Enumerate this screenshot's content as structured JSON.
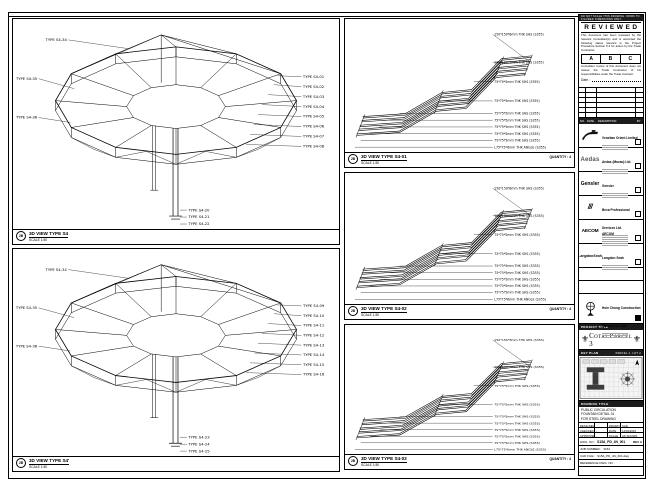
{
  "panels": {
    "p1": {
      "bubble": "2B",
      "title": "3D VIEW TYPE S4",
      "scale": "SCALE 1:50",
      "top_labels": [
        "TYPE S4-34"
      ],
      "left_labels": [
        "TYPE S4-35",
        "TYPE S4-36"
      ],
      "right_labels": [
        "TYPE S4-01",
        "TYPE S4-02",
        "TYPE S4-03",
        "TYPE S4-04",
        "TYPE S4-05",
        "TYPE S4-06",
        "TYPE S4-07",
        "TYPE S4-08"
      ],
      "bottom_labels": [
        "TYPE S4-20",
        "TYPE S4-21",
        "TYPE S4-22"
      ]
    },
    "p2": {
      "bubble": "2B",
      "title": "3D VIEW TYPE S4'",
      "scale": "SCALE 1:50",
      "top_labels": [
        "TYPE S4-34"
      ],
      "left_labels": [
        "TYPE S4-35",
        "TYPE S4-36"
      ],
      "right_labels": [
        "TYPE S4-09",
        "TYPE S4-10",
        "TYPE S4-11",
        "TYPE S4-12",
        "TYPE S4-13",
        "TYPE S4-14",
        "TYPE S4-15",
        "TYPE S4-16"
      ],
      "bottom_labels": [
        "TYPE S4-23",
        "TYPE S4-24",
        "TYPE S4-25"
      ]
    },
    "m1": {
      "bubble": "2B",
      "title": "3D VIEW TYPE S4-01",
      "scale": "SCALE 1:50",
      "quantity": "QUANTITY : 4",
      "labels": [
        "150*150*8mm THK SHS (S355)",
        "100*100*5mm THK SHS (S355)",
        "75*75*5mm THK SHS (S355)",
        "75*75*5mm THK SHS (S355)",
        "75*75*5mm THK SHS (S355)",
        "75*75*5mm THK SHS (S355)",
        "75*75*5mm THK SHS (S355)",
        "75*75*5mm THK SHS (S355)",
        "75*75*5mm THK SHS (S355)",
        "L75*75*6mm THK ANGLE (S355)"
      ]
    },
    "m2": {
      "bubble": "2B",
      "title": "3D VIEW TYPE S4-02",
      "scale": "SCALE 1:50",
      "quantity": "QUANTITY : 4",
      "labels": [
        "150*150*8mm THK SHS (S355)",
        "100*100*5mm THK SHS (S355)",
        "75*75*5mm THK SHS (S355)",
        "75*75*5mm THK SHS (S355)",
        "75*75*5mm THK SHS (S355)",
        "75*75*5mm THK SHS (S355)",
        "75*75*5mm THK SHS (S355)",
        "75*75*5mm THK SHS (S355)",
        "75*75*5mm THK SHS (S355)",
        "L75*75*6mm THK ANGLE (S355)"
      ]
    },
    "m3": {
      "bubble": "2B",
      "title": "3D VIEW TYPE S4-03",
      "scale": "SCALE 1:50",
      "quantity": "QUANTITY : 4",
      "labels": [
        "150*150*8mm THK SHS (S355)",
        "100*100*5mm THK SHS (S355)",
        "75*75*5mm THK SHS (S355)",
        "75*75*5mm THK SHS (S355)",
        "75*75*5mm THK SHS (S355)",
        "75*75*5mm THK SHS (S355)",
        "75*75*5mm THK SHS (S355)",
        "75*75*5mm THK SHS (S355)",
        "75*75*5mm THK SHS (S355)",
        "L75*75*6mm THK ANGLE (S355)"
      ]
    }
  },
  "titleblock": {
    "header_note": "DO NOT SCALE THIS DRAWING. WORK TO FIGURED DIMENSIONS ONLY.",
    "stamp": {
      "title": "REVIEWED",
      "note1": "This document has been reviewed by the relevant Consultant(s) and is accorded the following status relevant to the Project Procedure Section 5.4 for action by the Trade Contractor.",
      "options": [
        "A",
        "B",
        "C"
      ],
      "note2": "Consultant review of this document does not relieve the Trade Contractor of his responsibilities under the Trade Contract.",
      "date_label": "Date :"
    },
    "revision_table": {
      "col_no": "NO.",
      "col_date": "DATE",
      "col_desc": "DESCRIPTION",
      "col_by": "BY"
    },
    "consultants": [
      {
        "name": "Venetian Orient Limited"
      },
      {
        "logo": "Aedas",
        "name": "Aedas (Macau) Ltd."
      },
      {
        "logo": "Gensler",
        "name": "Gensler"
      },
      {
        "logo": "///",
        "name": "Beca Professional Services Ltd."
      },
      {
        "logo": "AECOM",
        "name": "AECOM"
      },
      {
        "logo": "LangdonSeah",
        "name": "Langdon Seah"
      }
    ],
    "contractor": {
      "name": "Hsin Chong Construction (Macau) Co. Ltd."
    },
    "project": {
      "label": "PROJECT TITLE",
      "name": "Cotai Parcel 3",
      "ornament": "⚜"
    },
    "key_plan": {
      "label": "KEY PLAN",
      "right_label": "PARCEL 1, LOT 2"
    },
    "drawing": {
      "label": "DRAWING TITLE",
      "line1": "PUBLIC CIRCULATION",
      "line2": "FOUNTAIN DETAIL 31",
      "line3": "FOR STEEL DRAWING"
    },
    "info": {
      "designed_label": "DESIGNED",
      "designed": "",
      "drawn_label": "DRAWN",
      "drawn": "CAD",
      "checked_label": "CHECKED",
      "checked": "-",
      "date_label": "DATE",
      "date": "14/03/2015",
      "approved_label": "APPROVED",
      "approved": "-",
      "scale_label": "SCALE",
      "scale": "AS SHOWN",
      "dwg_label": "DWG. NO :",
      "dwg_no": "S15A_PD_4N_001",
      "rev": "REV A",
      "job_label": "JOB NUMBER :",
      "job": "3152",
      "cad_label": "CAD FILE :",
      "cad_file": "S15A_PD_4N_001.dwg",
      "ref_label": "REFERENCE DWG. NO :"
    }
  }
}
